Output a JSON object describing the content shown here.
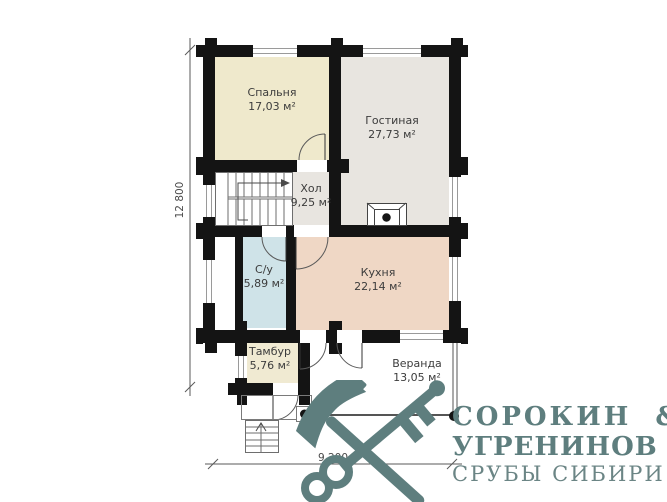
{
  "plan": {
    "title": "first-floor-plan",
    "rooms": [
      {
        "id": "bedroom",
        "name": "Спальня",
        "area": "17,03 м²",
        "color": "#efe9cc"
      },
      {
        "id": "living",
        "name": "Гостиная",
        "area": "27,73 м²",
        "color": "#e8e5e0"
      },
      {
        "id": "hall",
        "name": "Хол",
        "area": "9,25 м²",
        "color": "#e8e5e0"
      },
      {
        "id": "bathroom",
        "name": "С/у",
        "area": "5,89 м²",
        "color": "#cfe3e8"
      },
      {
        "id": "kitchen",
        "name": "Кухня",
        "area": "22,14 м²",
        "color": "#efd7c5"
      },
      {
        "id": "vestibule",
        "name": "Тамбур",
        "area": "5,76 м²",
        "color": "#f0ead2"
      },
      {
        "id": "veranda",
        "name": "Веранда",
        "area": "13,05 м²",
        "color": "#ffffff"
      }
    ],
    "dimensions": {
      "vertical": "12 800",
      "horizontal": "9 200"
    },
    "wall_color": "#141414"
  },
  "logo": {
    "line1": "СОРОКИН &",
    "line2": "УГРЕНИНОВ",
    "line3": "СРУБЫ СИБИРИ",
    "color": "#5e7e7e",
    "color_sub": "#6b8585",
    "icon": "axe-and-key"
  }
}
